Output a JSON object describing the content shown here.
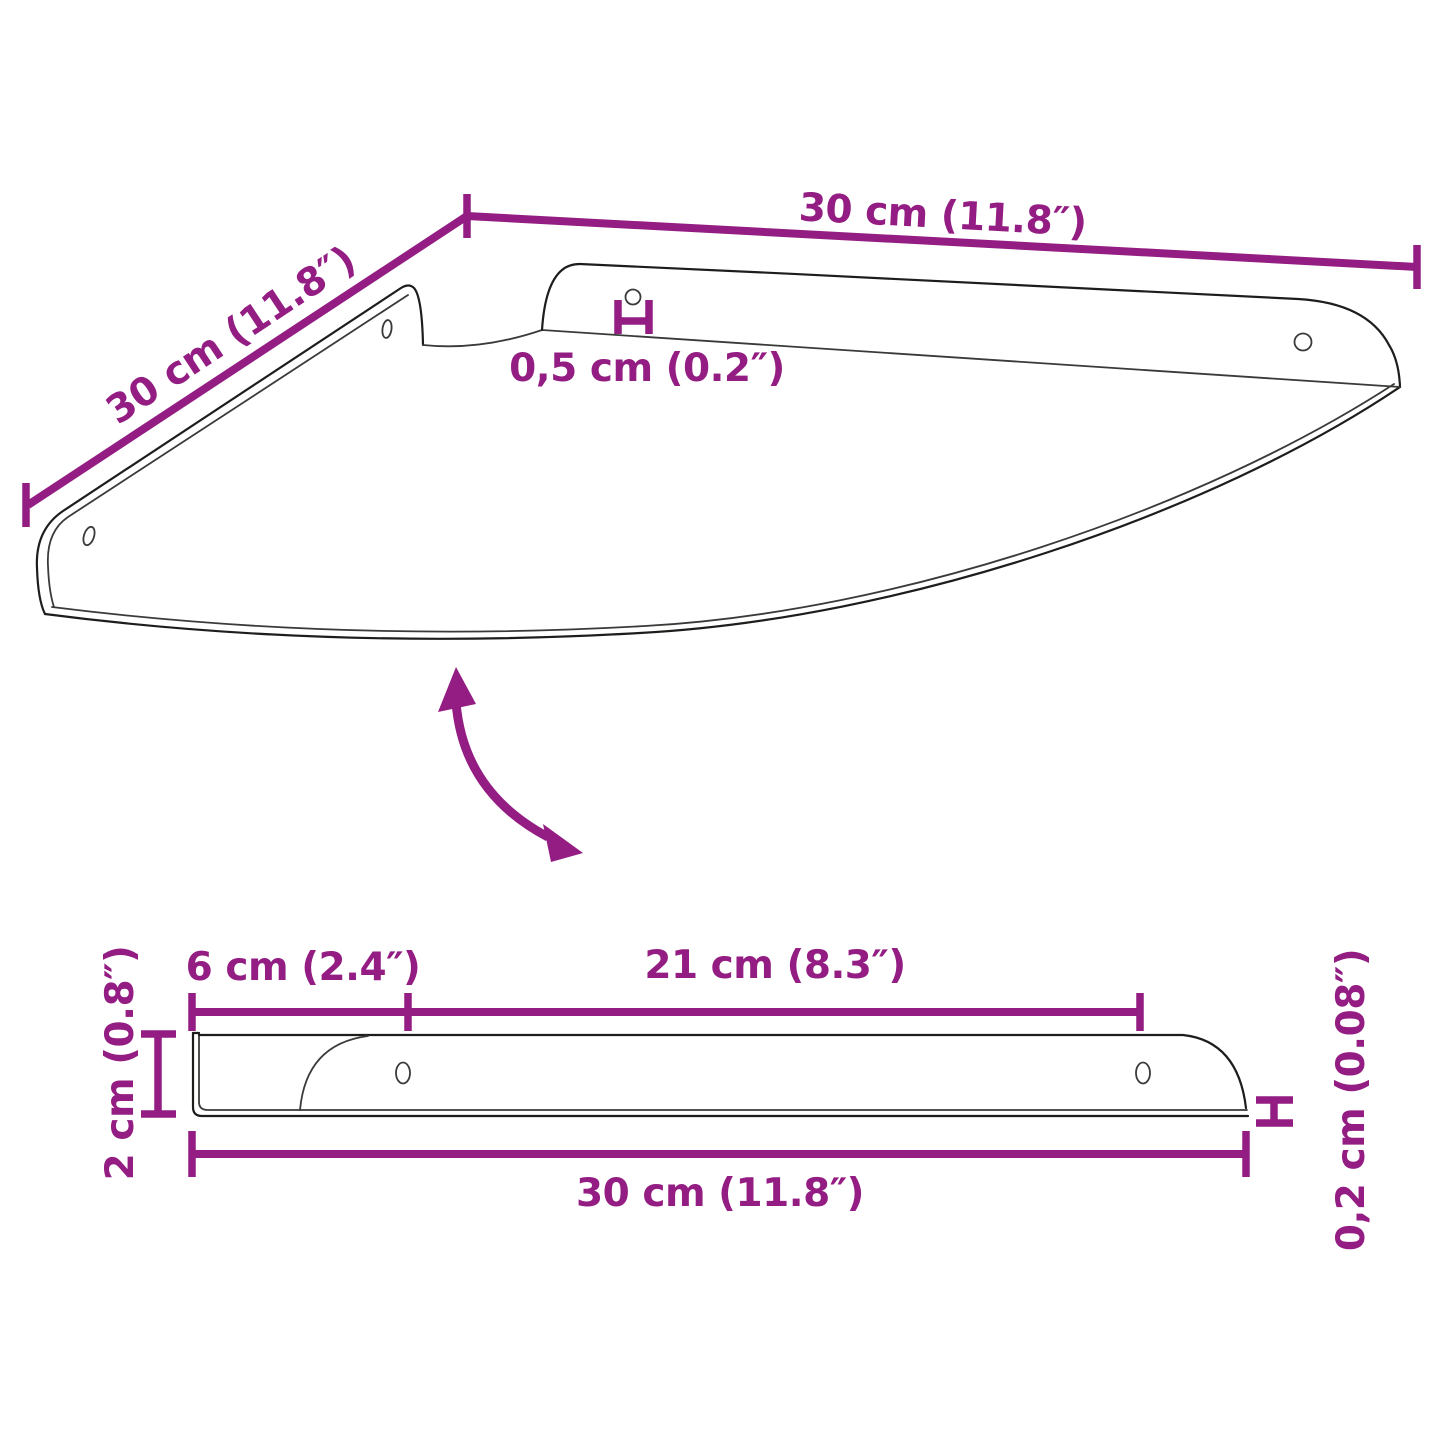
{
  "figure": {
    "kind": "product-dimension-diagram",
    "subject": "corner wall shelf with mounting brackets",
    "colors": {
      "dimension_accent": "#931d82",
      "outline": "#1d1d1b",
      "background": "#ffffff"
    },
    "top_view": {
      "dim_width_right": "30 cm (11.8″)",
      "dim_width_left": "30 cm (11.8″)",
      "dim_hole_diameter": "0,5 cm (0.2″)"
    },
    "side_view": {
      "dim_bracket_depth": "6 cm (2.4″)",
      "dim_shelf_span": "21 cm (8.3″)",
      "dim_bracket_height": "2 cm (0.8″)",
      "dim_total_width": "30 cm (11.8″)",
      "dim_shelf_thickness": "0,2 cm (0.08″)"
    },
    "icons": {
      "rotation_arrow": "curved-double-headed-arrow"
    }
  }
}
